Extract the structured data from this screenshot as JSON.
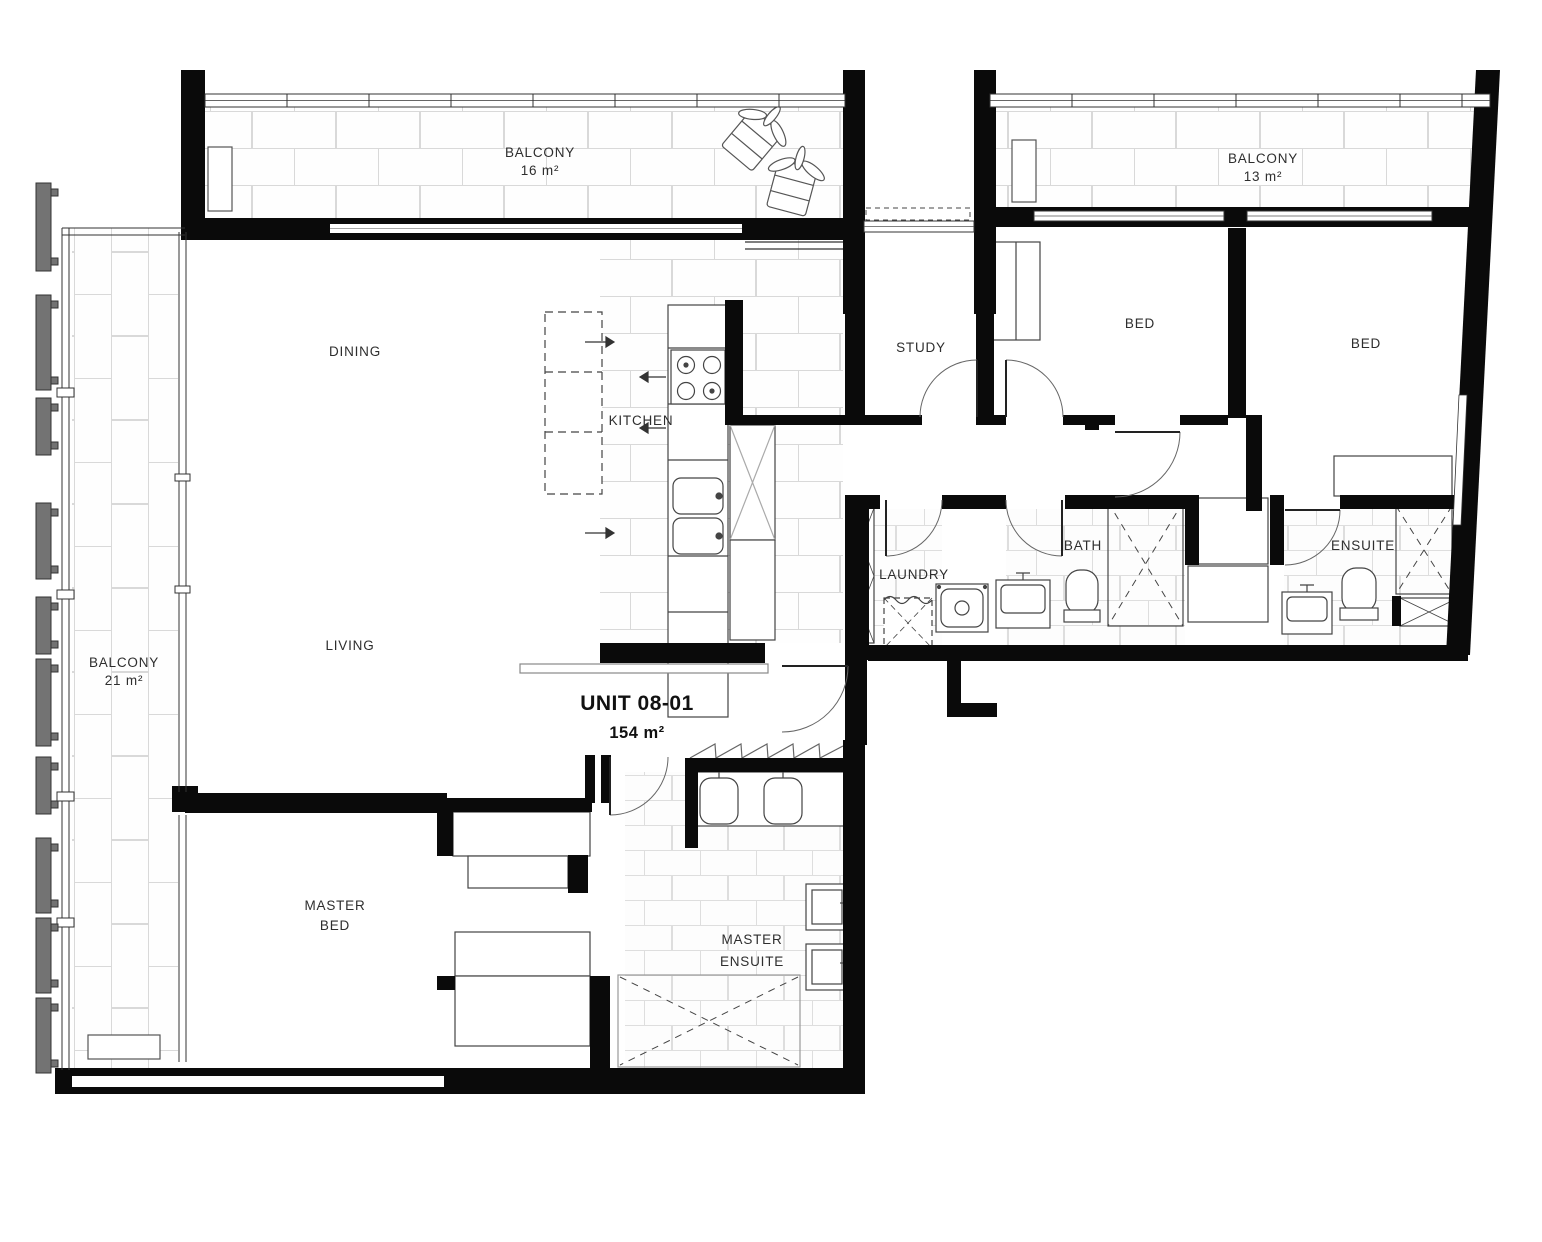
{
  "unit": {
    "title": "UNIT 08-01",
    "area": "154 m²"
  },
  "rooms": {
    "balcony_top_left": {
      "label": "BALCONY",
      "area": "16 m²"
    },
    "balcony_top_right": {
      "label": "BALCONY",
      "area": "13 m²"
    },
    "balcony_left": {
      "label": "BALCONY",
      "area": "21 m²"
    },
    "dining": {
      "label": "DINING"
    },
    "kitchen": {
      "label": "KITCHEN"
    },
    "living": {
      "label": "LIVING"
    },
    "study": {
      "label": "STUDY"
    },
    "bed_middle": {
      "label": "BED"
    },
    "bed_right": {
      "label": "BED"
    },
    "laundry": {
      "label": "LAUNDRY"
    },
    "bath": {
      "label": "BATH"
    },
    "ensuite": {
      "label": "ENSUITE"
    },
    "master_bed": {
      "label_line1": "MASTER",
      "label_line2": "BED"
    },
    "master_ensuite": {
      "label_line1": "MASTER",
      "label_line2": "ENSUITE"
    }
  },
  "colors": {
    "wall": "#0a0a0a",
    "fixture_line": "#444444",
    "tile_line": "#d9d9d9",
    "fin": "#737373",
    "background": "#ffffff"
  }
}
